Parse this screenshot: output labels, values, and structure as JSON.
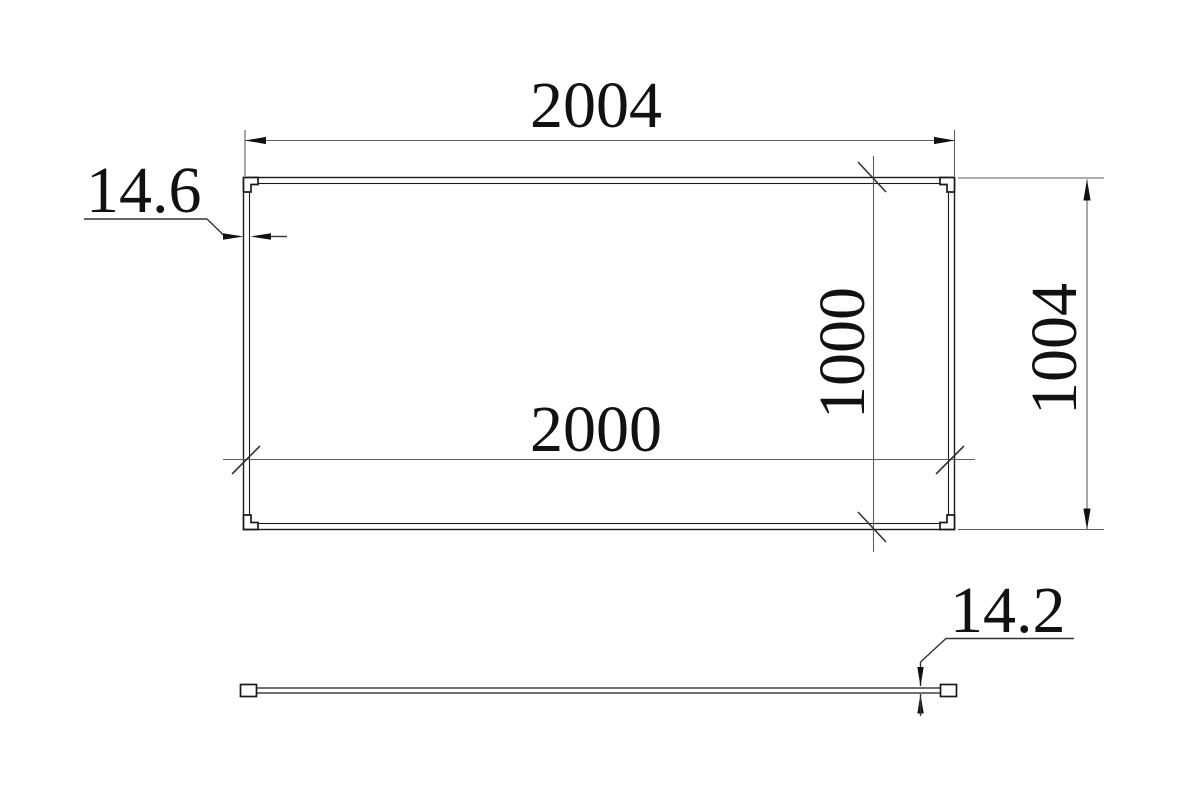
{
  "drawing": {
    "background_color": "#ffffff",
    "geometry_color": "#1a1a1a",
    "dimension_color": "#5f5f5f",
    "tick_color": "#333333",
    "text_color": "#111111",
    "dimensions": {
      "overall_width": {
        "value": "2004"
      },
      "inner_width": {
        "value": "2000"
      },
      "overall_height": {
        "value": "1004"
      },
      "inner_height": {
        "value": "1000"
      },
      "frame_thickness": {
        "value": "14.6"
      },
      "panel_thickness": {
        "value": "14.2"
      }
    }
  }
}
